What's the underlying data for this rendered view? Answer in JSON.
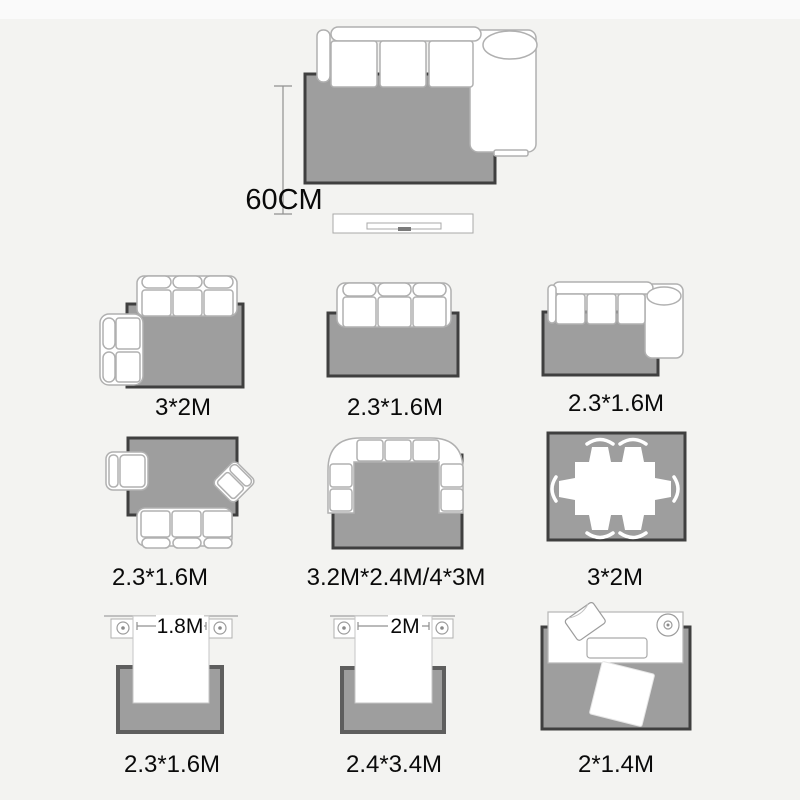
{
  "colors": {
    "background": "#f3f3f1",
    "background_top": "#fafafa",
    "rug_fill": "#9e9e9e",
    "rug_border_dark": "#3f3f3f",
    "rug_border_soft": "#5e5e5e",
    "furniture_fill": "#ffffff",
    "furniture_stroke": "#b0b0b0",
    "dim_line": "#909090",
    "text": "#0a0a0a"
  },
  "hero": {
    "dimension_label": "60CM"
  },
  "beds": {
    "bed1_label": "1.8M",
    "bed2_label": "2M"
  },
  "cells": [
    {
      "id": "living-sofa-with-loveseat",
      "label": "3*2M"
    },
    {
      "id": "living-three-seat-sofa",
      "label": "2.3*1.6M"
    },
    {
      "id": "living-chaise-sectional",
      "label": "2.3*1.6M"
    },
    {
      "id": "living-sofa-two-armchairs",
      "label": "2.3*1.6M"
    },
    {
      "id": "living-u-shaped-sectional",
      "label": "3.2M*2.4M/4*3M"
    },
    {
      "id": "dining-table-six-chairs",
      "label": "3*2M"
    },
    {
      "id": "bedroom-bed-1-8m",
      "label": "2.3*1.6M"
    },
    {
      "id": "bedroom-bed-2m",
      "label": "2.4*3.4M"
    },
    {
      "id": "desk-with-seat",
      "label": "2*1.4M"
    }
  ]
}
